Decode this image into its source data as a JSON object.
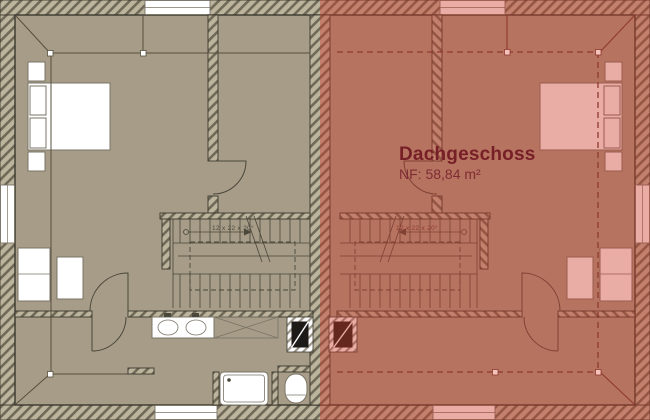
{
  "plan": {
    "floor_title": "Dachgeschoss",
    "floor_area": "NF: 58,84 m²",
    "stairs": {
      "left_label": "12 x 22 x 20°",
      "right_label": "12 x 22 x 20°"
    }
  },
  "colors": {
    "interior": "#a79c87",
    "wall-line": "#3a382e",
    "hatch-bg": "#bdb49d",
    "hatch-stripe": "#6f6a57",
    "furniture-line": "#7a7467",
    "stair-line": "#4a473b",
    "knee-line": "#55503f",
    "title-color": "#771f27",
    "subtitle-color": "#7f2c33",
    "highlight-line": "#8e3a30",
    "highlight-anchor-fill": "#f3c3bc",
    "overlay-fill": "rgba(203,60,44,0.42)"
  }
}
